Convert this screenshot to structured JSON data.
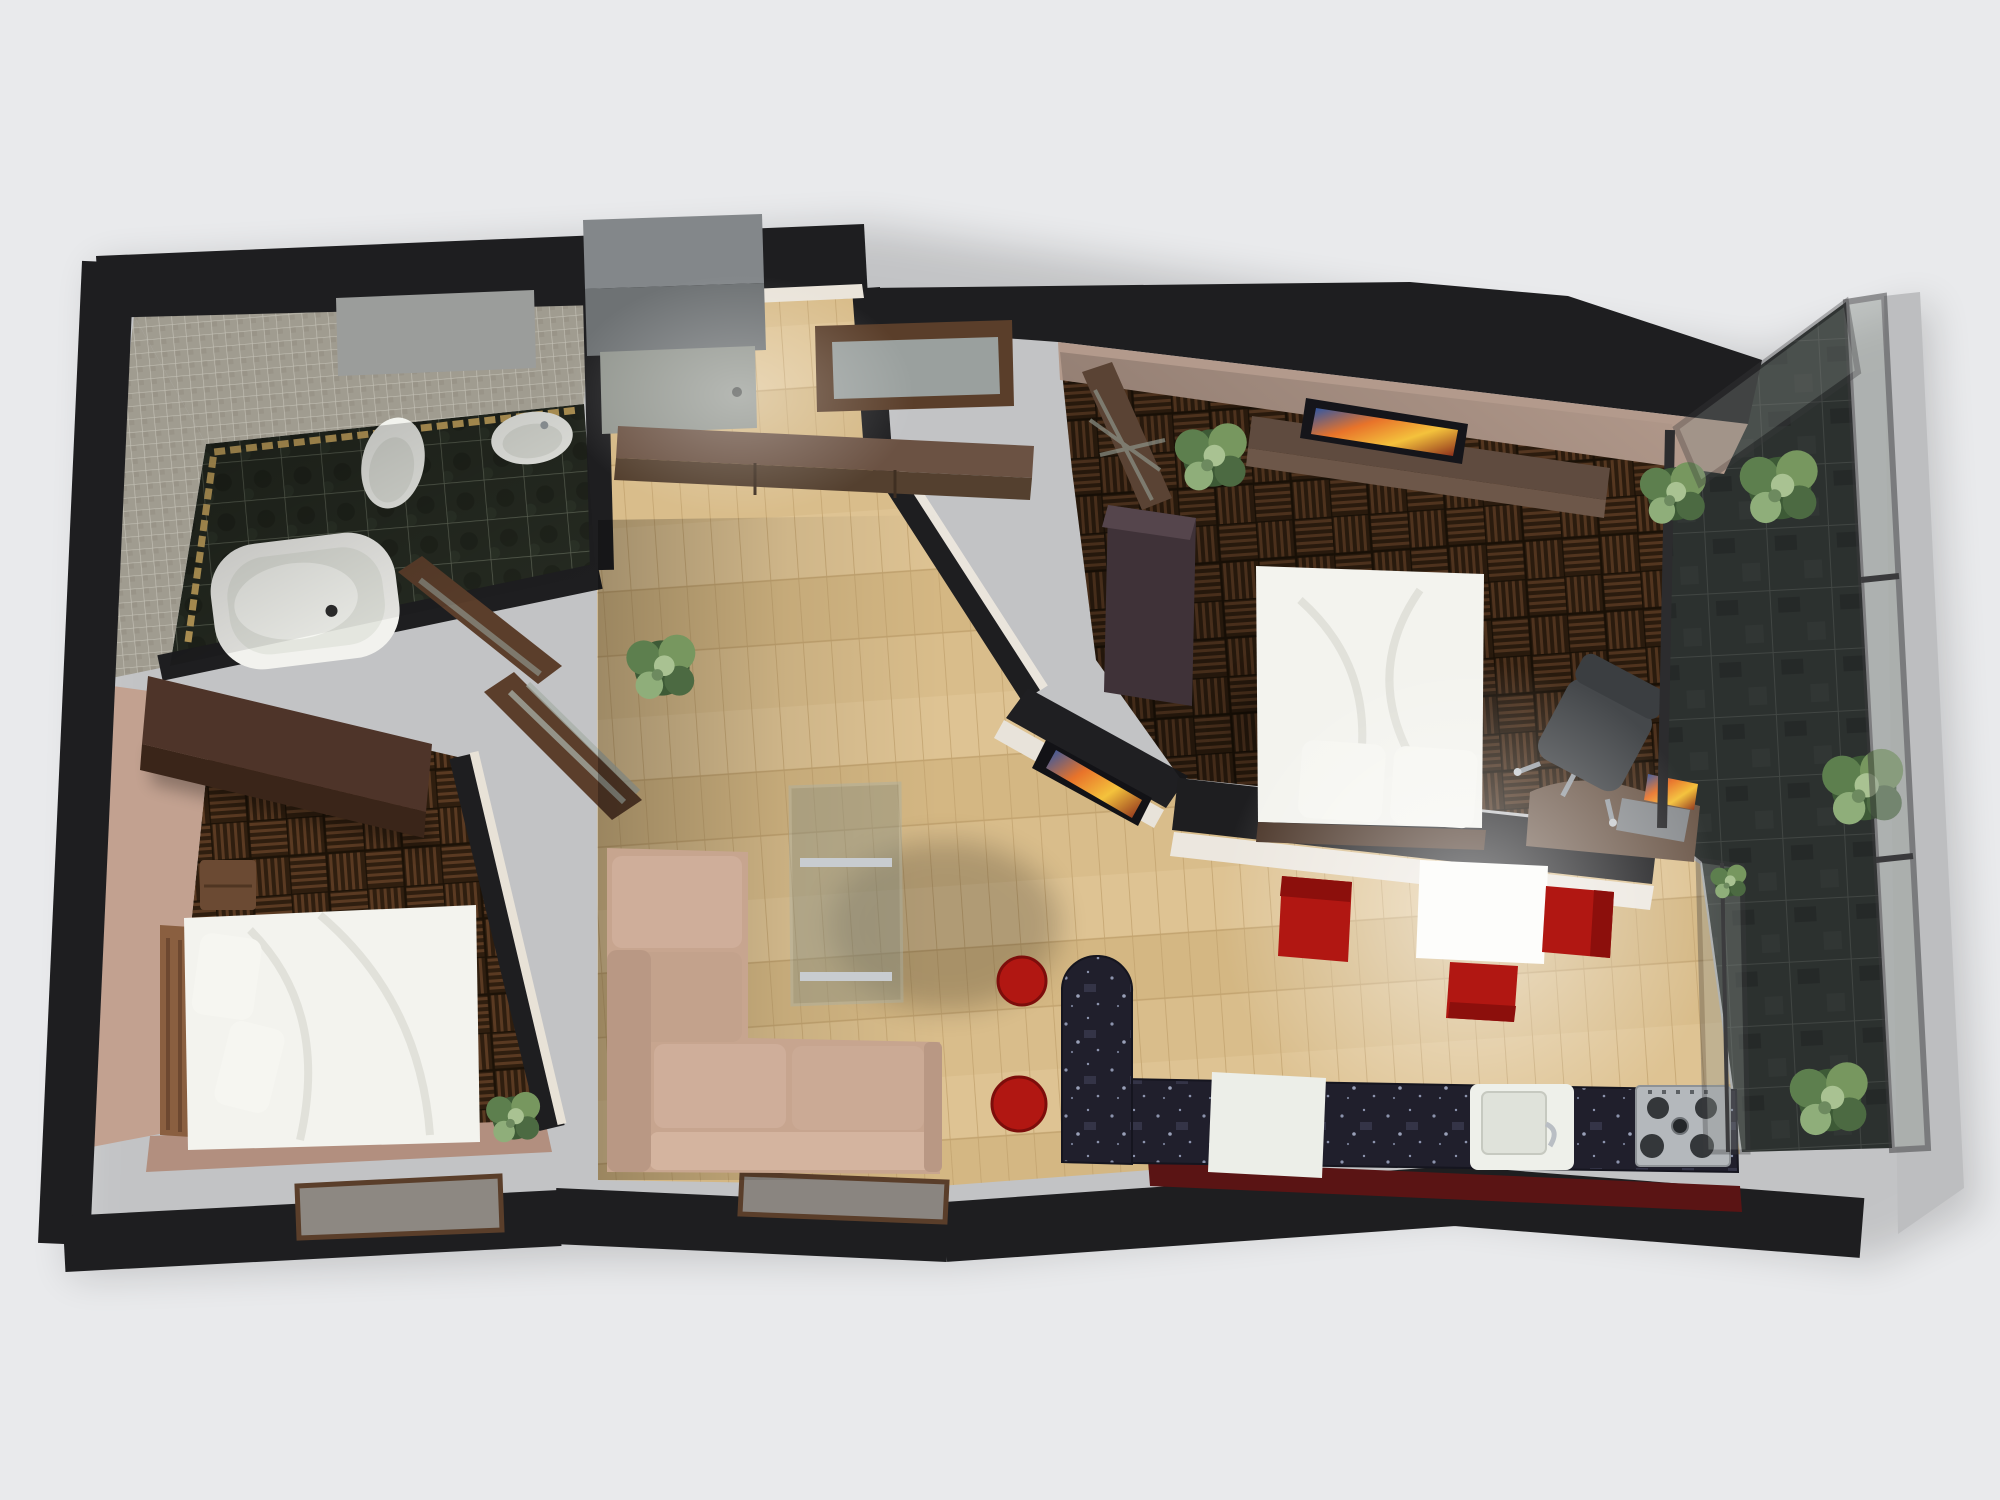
{
  "scene": {
    "title": "3D apartment floor-plan render",
    "view": "top-down cutaway 3D render, no visible text",
    "background": "#e9eaec",
    "rooms": [
      {
        "id": "bathroom",
        "label": "Bathroom",
        "floor": "dark marble tile",
        "walls": "grey mosaic tile with gold trim",
        "items": [
          "corner bathtub",
          "toilet",
          "wash basin",
          "open wooden door"
        ]
      },
      {
        "id": "bedroom-left",
        "label": "Left bedroom",
        "floor": "dark basket-weave parquet",
        "walls": "tan plaster",
        "items": [
          "double bed with white duvet",
          "two pillows",
          "slatted headboard",
          "wardrobe",
          "nightstand",
          "potted plant",
          "open glazed door"
        ]
      },
      {
        "id": "hall",
        "label": "Entrance hall",
        "floor": "light oak parquet",
        "items": [
          "grey entrance door",
          "window niche",
          "long storage console",
          "potted plant"
        ]
      },
      {
        "id": "living-room",
        "label": "Living room",
        "floor": "light oak parquet",
        "items": [
          "beige corner sofa",
          "glass coffee table with metal rails",
          "two red round stools",
          "TV on angled partition"
        ]
      },
      {
        "id": "bedroom-right",
        "label": "Right bedroom",
        "floor": "dark basket-weave parquet",
        "items": [
          "double bed with white duvet",
          "two pillows",
          "TV sideboard",
          "flat TV",
          "wardrobe",
          "lattice door",
          "desk with laptop",
          "office chair",
          "potted plant"
        ]
      },
      {
        "id": "kitchen-dining",
        "label": "Kitchen / dining",
        "floor": "light oak parquet with dark red service strip",
        "items": [
          "L-shaped dark marble counter with round-ended bar",
          "white cabinet",
          "sink with faucet",
          "gas hob",
          "white dining table",
          "three red chairs"
        ]
      },
      {
        "id": "balcony",
        "label": "Glazed balcony / winter garden",
        "floor": "grey stone tile",
        "items": [
          "framed glass wall",
          "five potted plants"
        ]
      }
    ],
    "palette": {
      "wall_dark": "#1e1e20",
      "light_parquet": "#d9bd8b",
      "dark_parquet": "#2f1e0f",
      "accent_red": "#b11712",
      "sofa_beige": "#c7a58f",
      "counter_marble": "#201f2c",
      "balcony_stone": "#3e4442",
      "mosaic_grey": "#a09c90",
      "gold_trim": "#c9a860",
      "bedding_white": "#f3f3ee",
      "wood_brown": "#6b5243",
      "door_grey": "#92968f",
      "table_white": "#fdfdfb",
      "plant_green": "#5f7d52",
      "tan_wall": "#c2a190",
      "beige_wall": "#b39a8c"
    }
  }
}
